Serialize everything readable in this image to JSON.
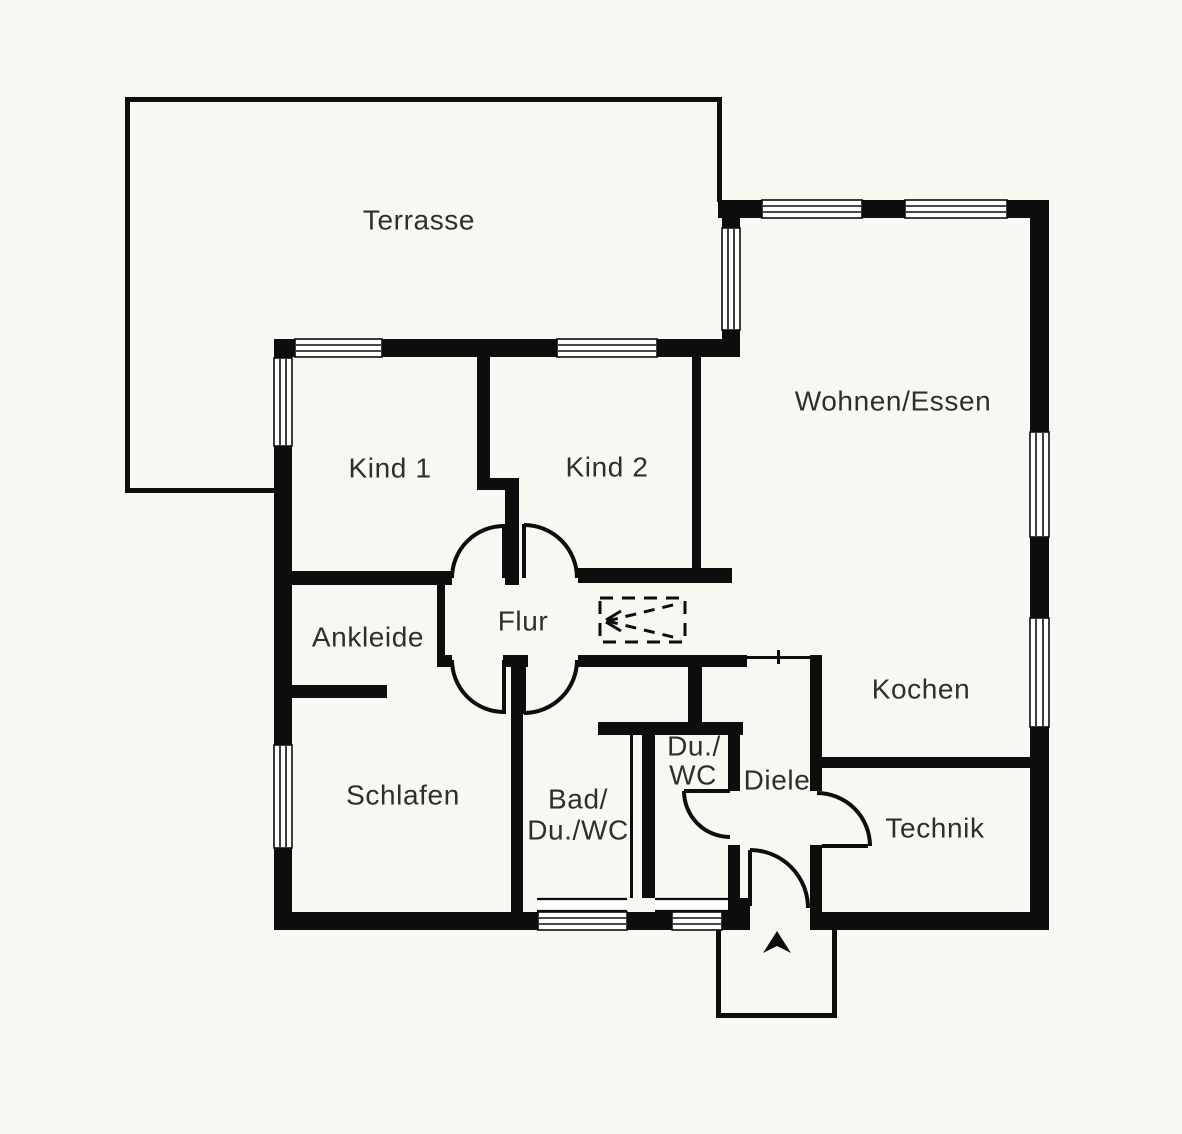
{
  "colors": {
    "background": "#f9f7f1",
    "wall": "#0d0d0d",
    "text": "#2e2e2e"
  },
  "rooms": {
    "terrasse": {
      "label": "Terrasse"
    },
    "kind1": {
      "label": "Kind 1"
    },
    "kind2": {
      "label": "Kind 2"
    },
    "wohnen": {
      "label": "Wohnen/Essen"
    },
    "ankleide": {
      "label": "Ankleide"
    },
    "flur": {
      "label": "Flur"
    },
    "kochen": {
      "label": "Kochen"
    },
    "schlafen": {
      "label": "Schlafen"
    },
    "bad": {
      "line1": "Bad/",
      "line2": "Du./WC"
    },
    "duwc": {
      "line1": "Du./",
      "line2": "WC"
    },
    "diele": {
      "label": "Diele"
    },
    "technik": {
      "label": "Technik"
    }
  },
  "symbols": {
    "north_arrow": "up-triangle"
  }
}
